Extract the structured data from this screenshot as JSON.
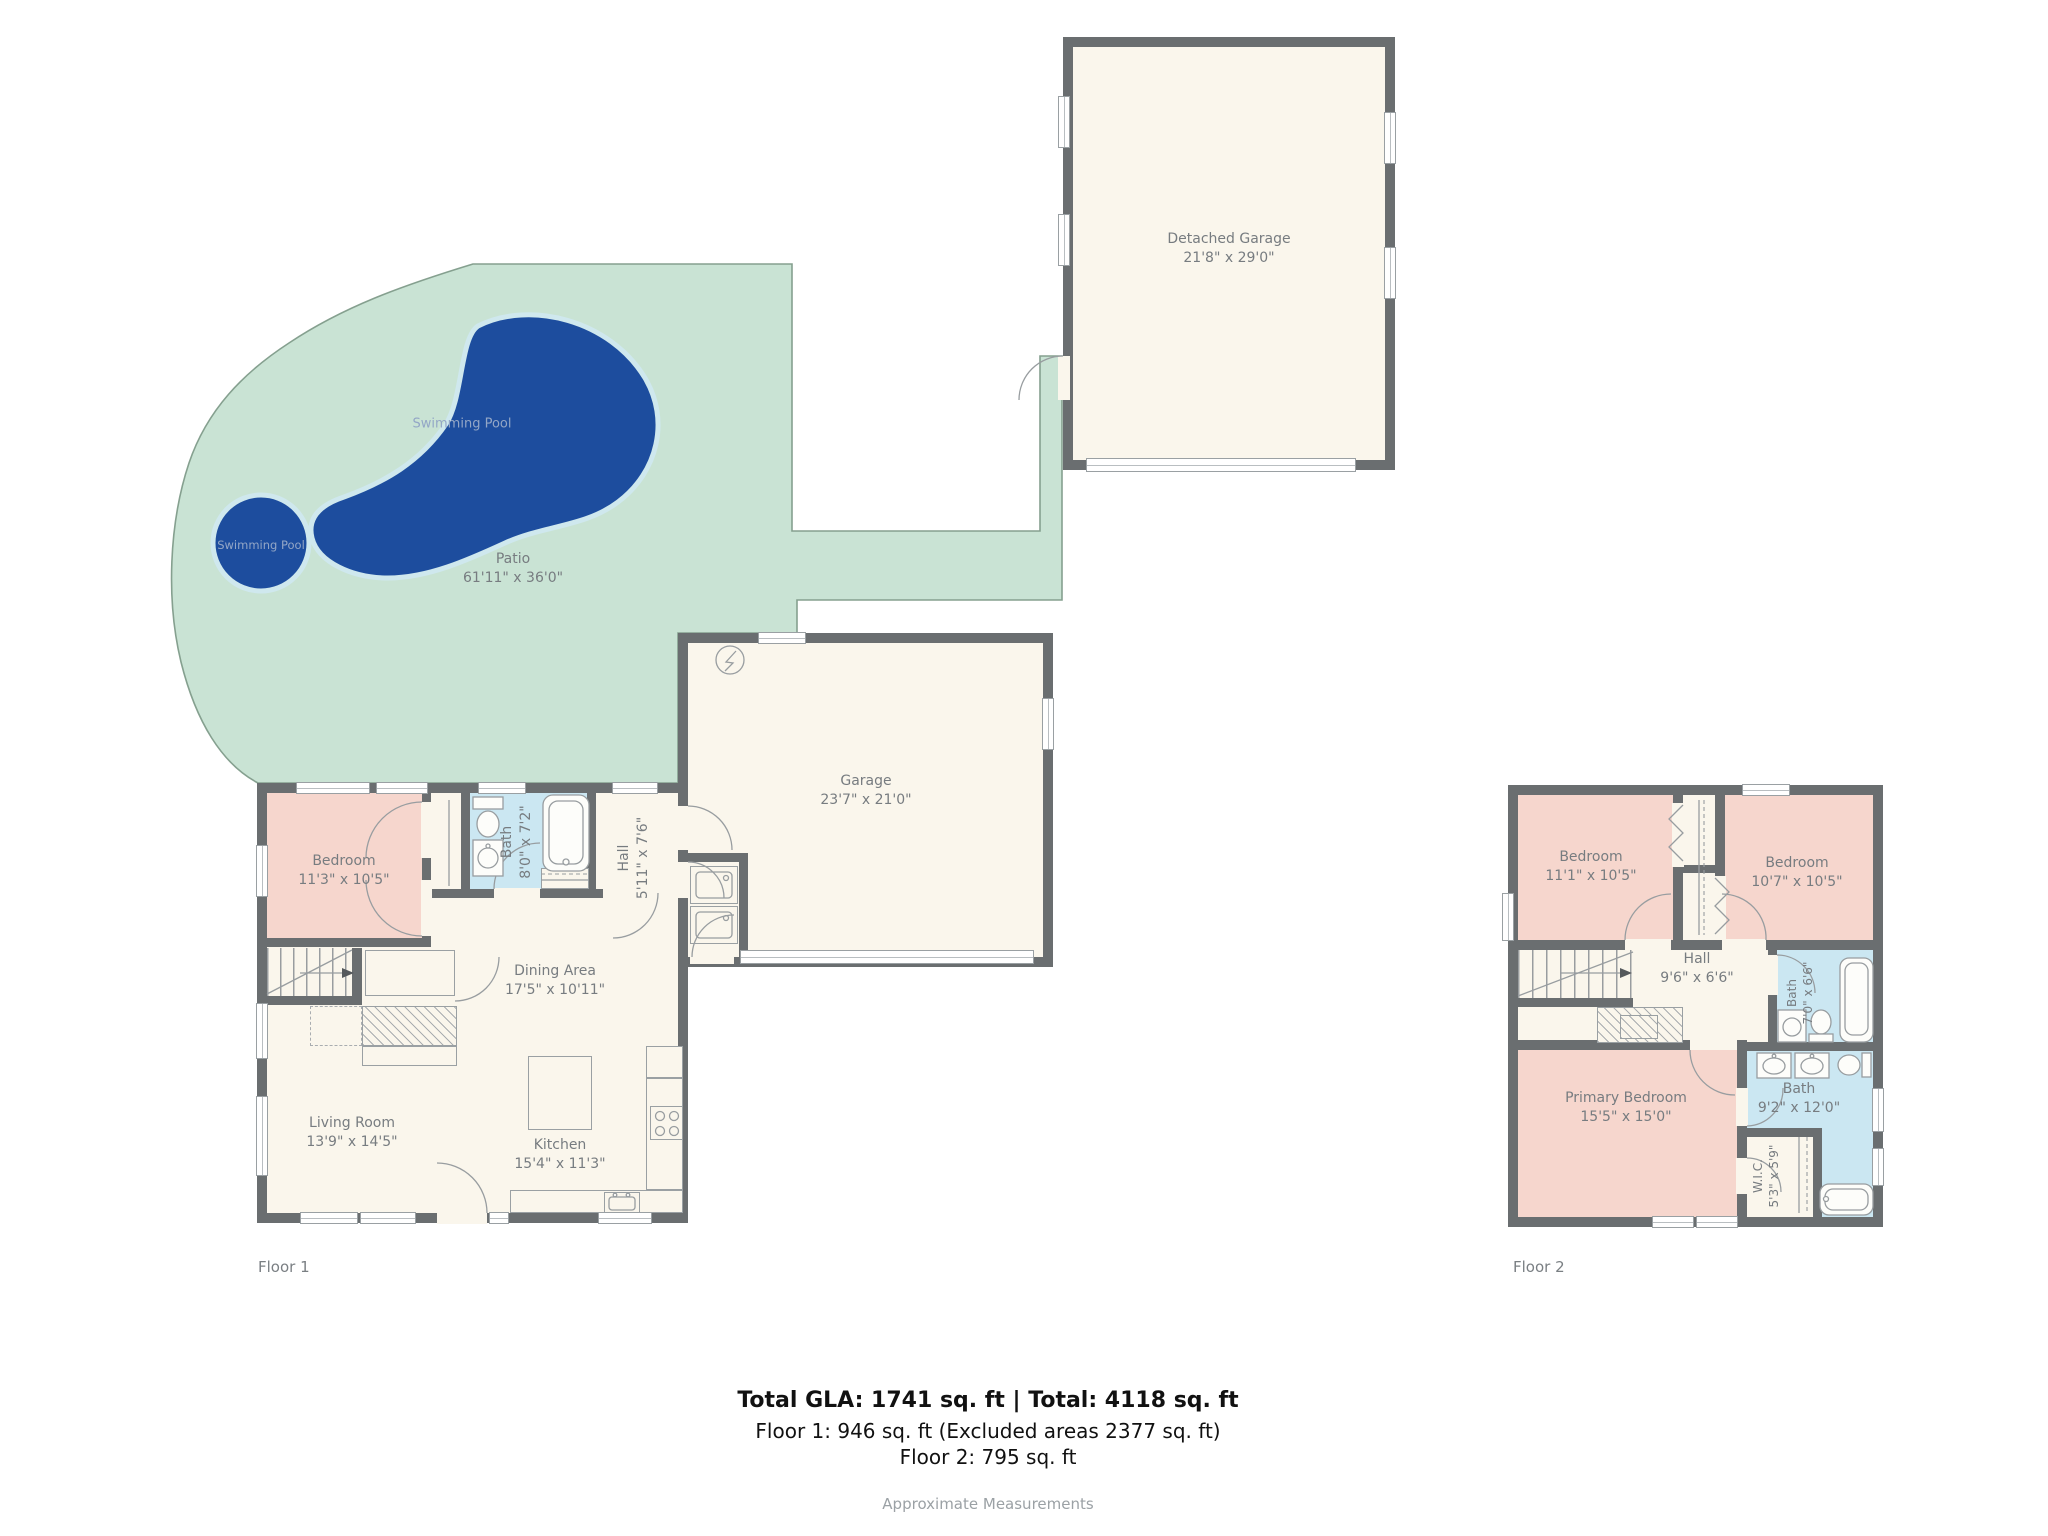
{
  "meta": {
    "floor1_label": "Floor 1",
    "floor2_label": "Floor 2",
    "summary_line1": "Total GLA: 1741 sq. ft | Total: 4118 sq. ft",
    "summary_line2": "Floor 1: 946 sq. ft (Excluded areas 2377 sq. ft)",
    "summary_line3": "Floor 2: 795 sq. ft",
    "summary_note": "Approximate Measurements"
  },
  "outdoor": {
    "patio": {
      "name": "Patio",
      "dims": "61'11\" x 36'0\""
    },
    "pool_main": {
      "label": "Swimming Pool"
    },
    "pool_round": {
      "label": "Swimming Pool"
    }
  },
  "detached_garage": {
    "name": "Detached Garage",
    "dims": "21'8\" x 29'0\""
  },
  "floor1": {
    "garage": {
      "name": "Garage",
      "dims": "23'7\" x 21'0\""
    },
    "bedroom": {
      "name": "Bedroom",
      "dims": "11'3\" x 10'5\""
    },
    "bath": {
      "name": "Bath",
      "dims": "8'0\" x 7'2\""
    },
    "hall": {
      "name": "Hall",
      "dims": "5'11\" x 7'6\""
    },
    "dining": {
      "name": "Dining Area",
      "dims": "17'5\" x 10'11\""
    },
    "living": {
      "name": "Living Room",
      "dims": "13'9\" x 14'5\""
    },
    "kitchen": {
      "name": "Kitchen",
      "dims": "15'4\" x 11'3\""
    }
  },
  "floor2": {
    "bedroom_left": {
      "name": "Bedroom",
      "dims": "11'1\" x 10'5\""
    },
    "bedroom_right": {
      "name": "Bedroom",
      "dims": "10'7\" x 10'5\""
    },
    "hall": {
      "name": "Hall",
      "dims": "9'6\" x 6'6\""
    },
    "bath_small": {
      "name": "Bath",
      "dims": "7'0\" x 6'6\""
    },
    "bath_primary": {
      "name": "Bath",
      "dims": "9'2\" x 12'0\""
    },
    "wic": {
      "name": "W.I.C.",
      "dims": "5'3\" x 5'9\""
    },
    "primary_bedroom": {
      "name": "Primary Bedroom",
      "dims": "15'5\" x 15'0\""
    }
  },
  "colors": {
    "wall": "#6a6e70",
    "floor": "#faf6ec",
    "bedroom": "#f6d6cd",
    "bath": "#cbe7f2",
    "patio": "#c9e3d4",
    "patio_edge": "#85a08f",
    "pool": "#1d4d9e",
    "pool_rim": "#cfe8ee",
    "label": "#777c80",
    "note": "#9ba1a5"
  }
}
